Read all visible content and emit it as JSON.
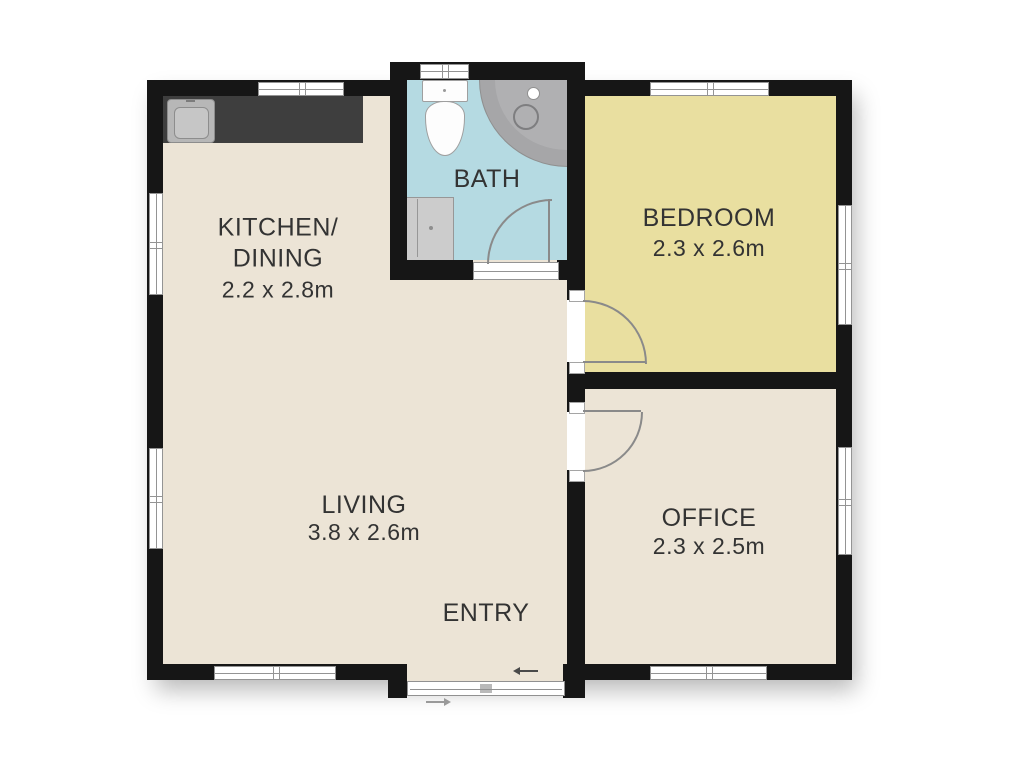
{
  "colors": {
    "wall": "#161616",
    "cream": "#ece4d6",
    "bedroom_yellow": "#e9dfa0",
    "bath_blue": "#b5dae2",
    "counter_dark": "#3e3e3e",
    "shower_gray": "#a6a6a8",
    "fixture_gray": "#cccccc",
    "label_text": "#333333"
  },
  "rooms": {
    "kitchen_dining": {
      "label_line1": "KITCHEN/",
      "label_line2": "DINING",
      "dims": "2.2 x 2.8m"
    },
    "bath": {
      "label": "BATH"
    },
    "bedroom": {
      "label": "BEDROOM",
      "dims": "2.3 x 2.6m"
    },
    "living": {
      "label": "LIVING",
      "dims": "3.8 x 2.6m"
    },
    "entry": {
      "label": "ENTRY"
    },
    "office": {
      "label": "OFFICE",
      "dims": "2.3 x 2.5m"
    }
  }
}
